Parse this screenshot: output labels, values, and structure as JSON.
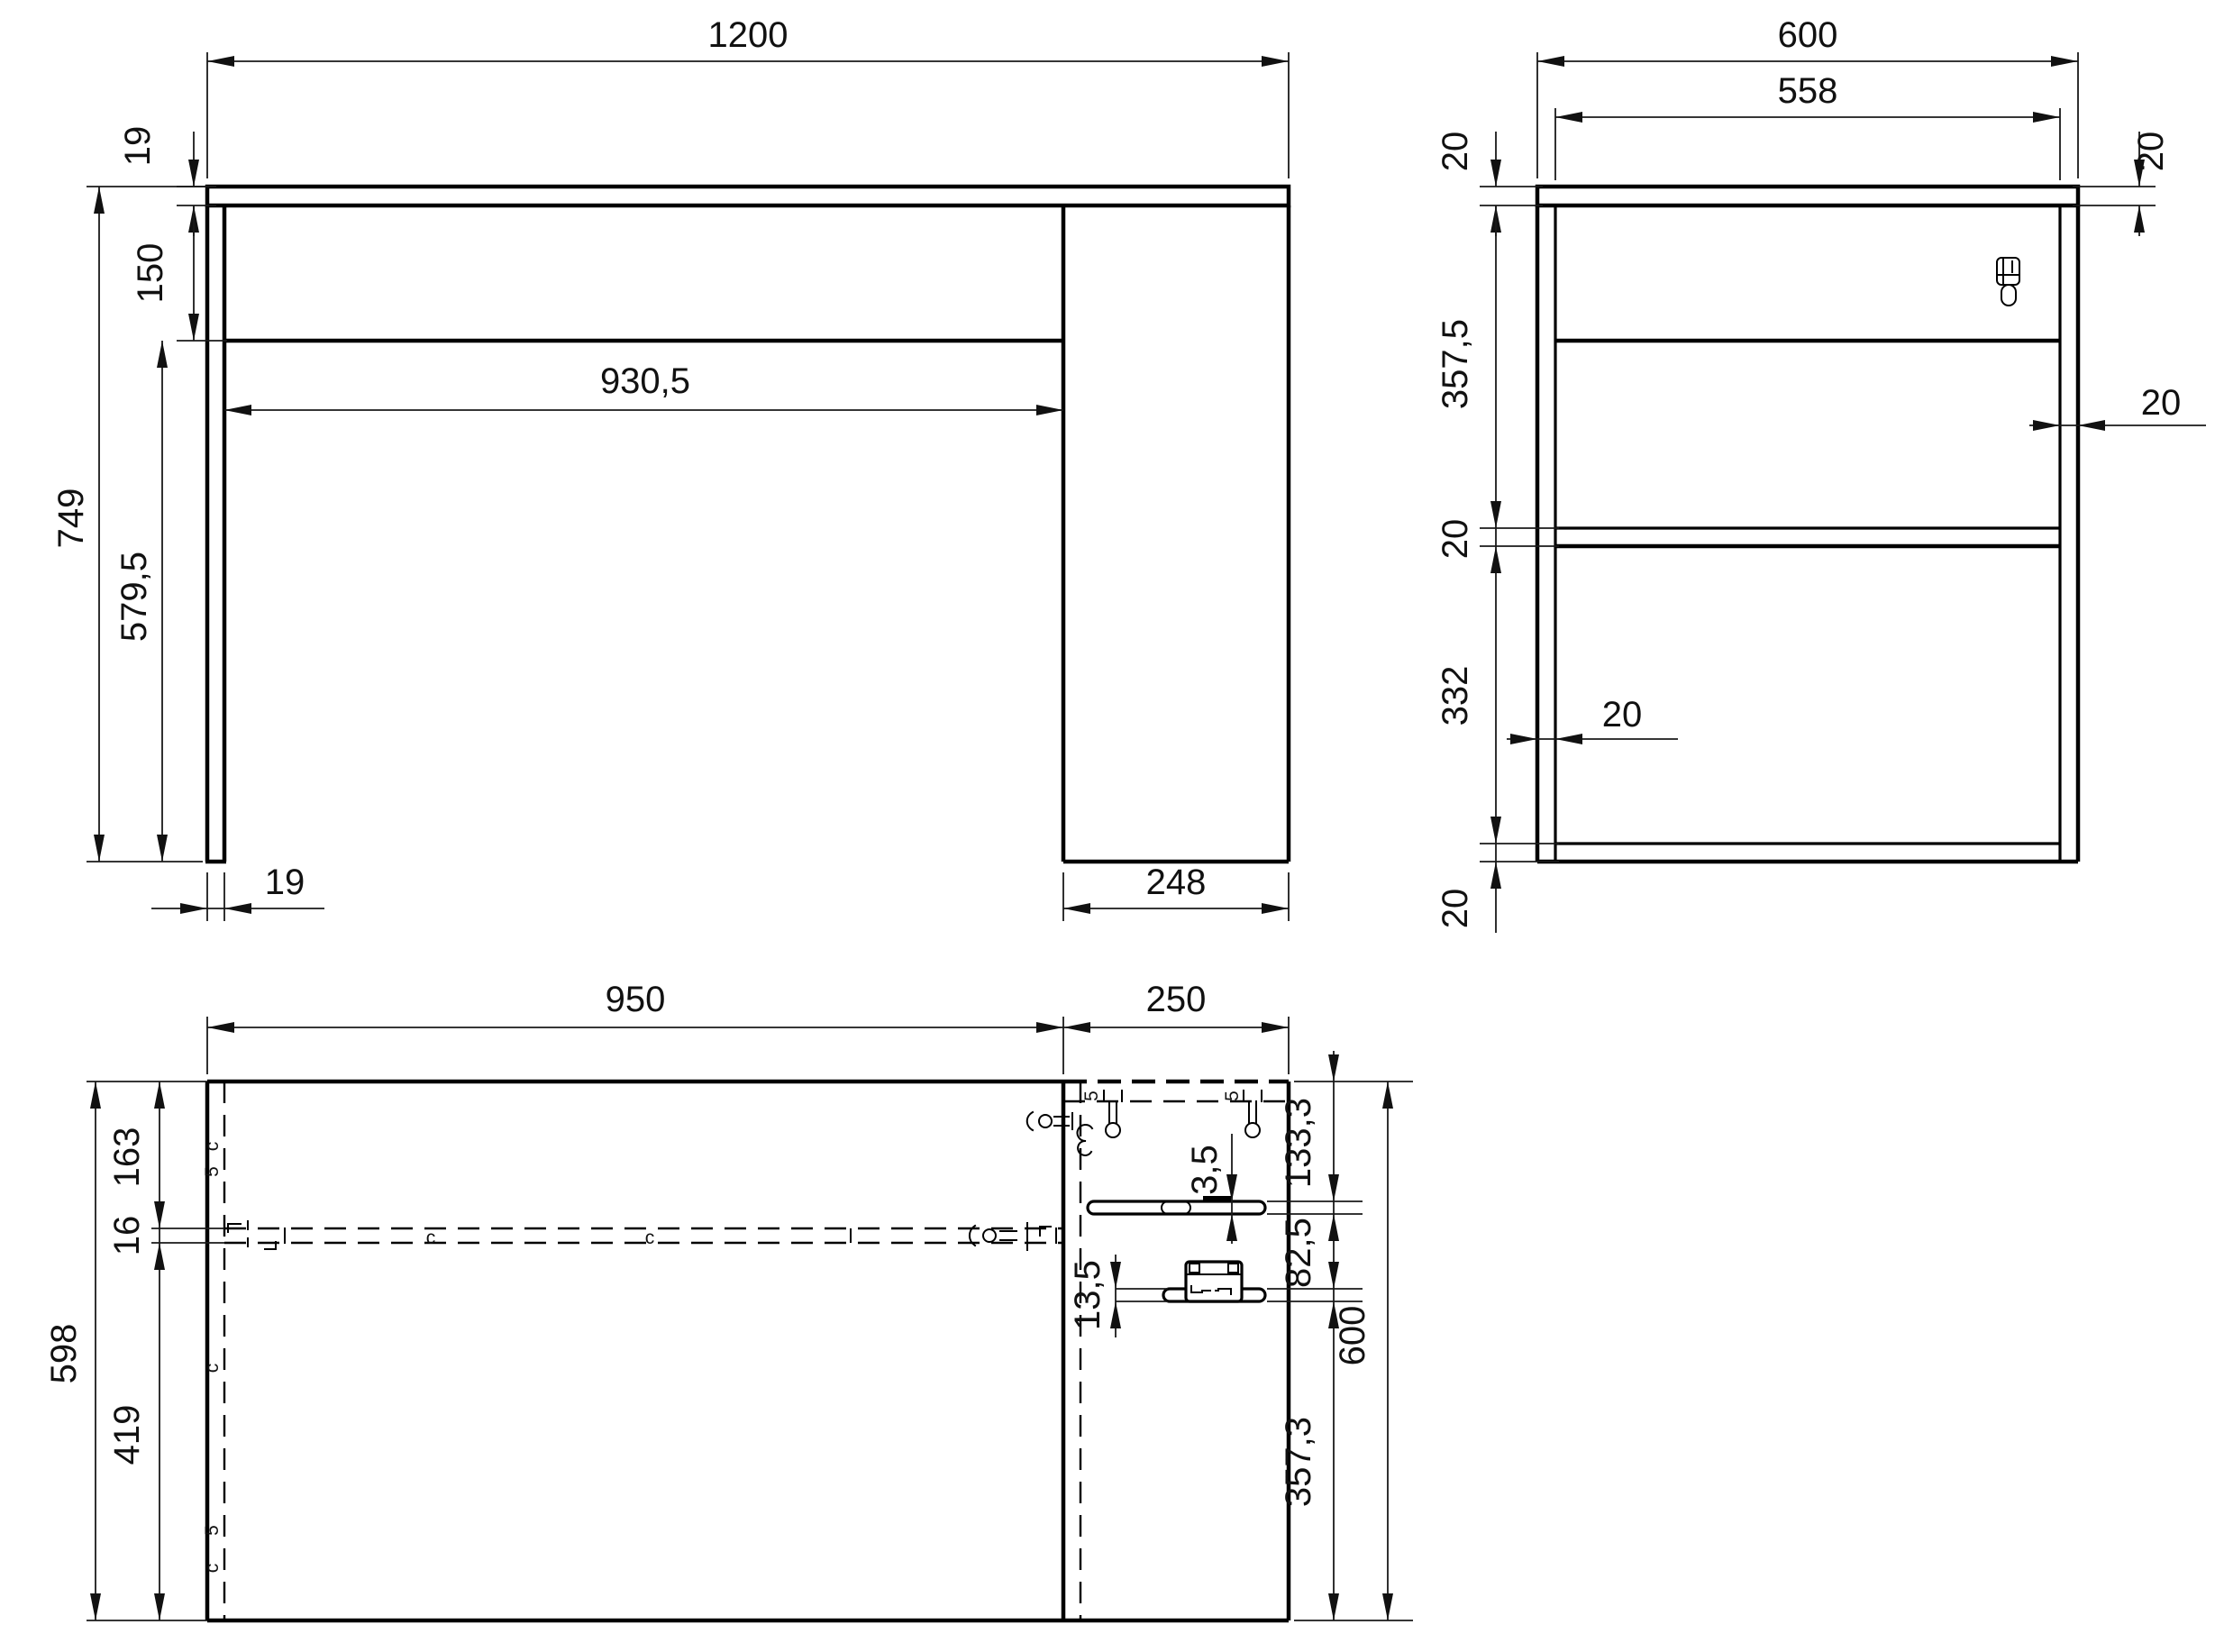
{
  "drawing": {
    "type": "furniture-orthographic-technical-drawing",
    "views": {
      "front": {
        "width": "1200",
        "top_thickness": "19",
        "apron_height": "150",
        "inner_span": "930,5",
        "total_height": "749",
        "leg_clear_height": "579,5",
        "leg_thickness": "19",
        "pedestal_width": "248"
      },
      "side": {
        "depth": "600",
        "inner_depth": "558",
        "top_thickness_left": "20",
        "top_thickness_right": "20",
        "upper_clear": "357,5",
        "shelf_thickness": "20",
        "lower_clear": "332",
        "bottom_thickness": "20",
        "right_wall_thickness": "20",
        "left_wall_thickness": "20"
      },
      "plan": {
        "left_span": "950",
        "pedestal_span": "250",
        "back_offset": "163",
        "rail_thickness": "16",
        "front_offset": "419",
        "depth_left": "598",
        "slot1_offset": "133,3",
        "slot_gap": "82,5",
        "depth_right": "600",
        "front_span": "357,3",
        "slot1_step": "3,5",
        "slot_height": "13,5"
      }
    },
    "markers": {
      "cam": "c",
      "dowel": "5"
    },
    "colors": {
      "line": "#000000",
      "background": "#ffffff"
    }
  }
}
